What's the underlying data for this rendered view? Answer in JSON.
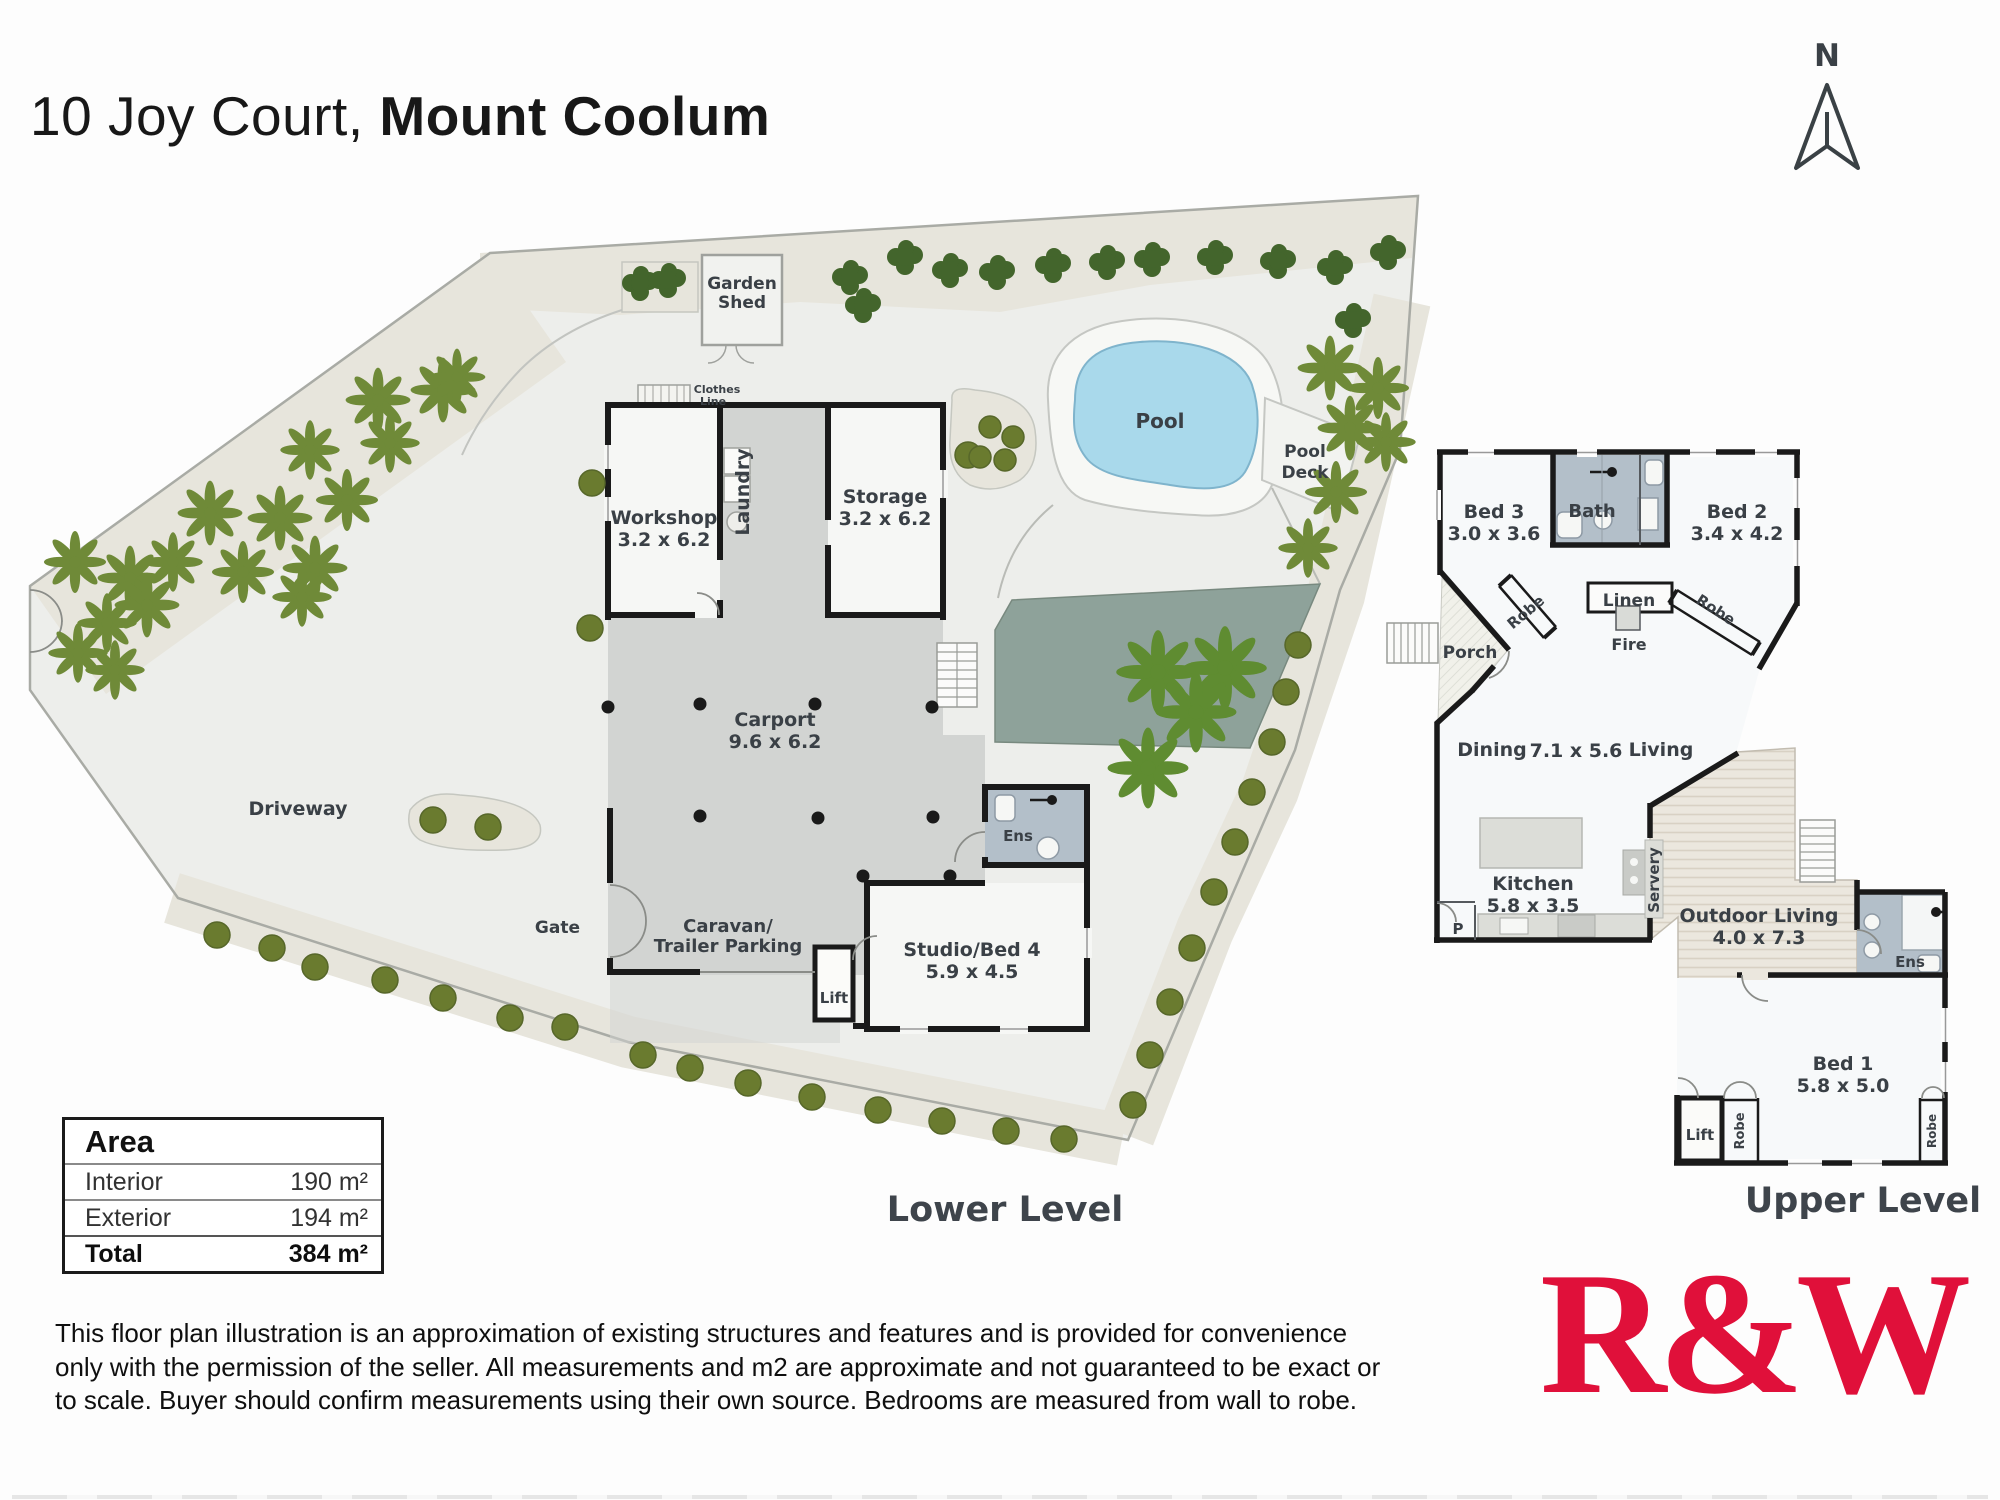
{
  "title": {
    "prefix": "10 Joy Court, ",
    "bold": "Mount Coolum"
  },
  "compass": "N",
  "levels": {
    "lower": "Lower Level",
    "upper": "Upper Level"
  },
  "area_table": {
    "header": "Area",
    "rows": [
      {
        "label": "Interior",
        "value": "190 m²"
      },
      {
        "label": "Exterior",
        "value": "194 m²"
      }
    ],
    "total": {
      "label": "Total",
      "value": "384 m²"
    }
  },
  "lower": {
    "garden_shed_line1": "Garden",
    "garden_shed_line2": "Shed",
    "clothes_line1": "Clothes",
    "clothes_line2": "Line",
    "workshop": "Workshop",
    "workshop_dim": "3.2 x 6.2",
    "laundry": "Laundry",
    "storage": "Storage",
    "storage_dim": "3.2 x 6.2",
    "pool": "Pool",
    "pool_deck_line1": "Pool",
    "pool_deck_line2": "Deck",
    "carport": "Carport",
    "carport_dim": "9.6 x 6.2",
    "driveway": "Driveway",
    "gate": "Gate",
    "caravan_line1": "Caravan/",
    "caravan_line2": "Trailer Parking",
    "lift": "Lift",
    "ens": "Ens",
    "studio": "Studio/Bed 4",
    "studio_dim": "5.9 x 4.5"
  },
  "upper": {
    "bed3": "Bed 3",
    "bed3_dim": "3.0 x 3.6",
    "bath": "Bath",
    "bed2": "Bed 2",
    "bed2_dim": "3.4 x 4.2",
    "linen": "Linen",
    "fire": "Fire",
    "robe_left": "Robe",
    "robe_right": "Robe",
    "porch": "Porch",
    "dining": "Dining",
    "living_dim": "7.1 x 5.6",
    "living": "Living",
    "kitchen": "Kitchen",
    "kitchen_dim": "5.8 x 3.5",
    "servery": "Servery",
    "pantry": "P",
    "outdoor": "Outdoor Living",
    "outdoor_dim": "4.0 x 7.3",
    "ens": "Ens",
    "bed1": "Bed 1",
    "bed1_dim": "5.8 x 5.0",
    "lift": "Lift",
    "robe1": "Robe",
    "robe2": "Robe"
  },
  "disclaimer": {
    "line1": "This floor plan illustration is an approximation of existing structures and features and is provided for convenience",
    "line2": "only with the permission of the seller. All measurements and m2 are approximate and not guaranteed to be exact or",
    "line3": "to scale. Buyer should confirm measurements using their own source. Bedrooms are measured from wall to robe."
  },
  "logo": "R&W",
  "colors": {
    "logo_red": "#E0103A",
    "pool_blue": "#A9D9EB",
    "deck_sage": "#8EA29A",
    "carport_grey": "#D2D4D2",
    "bath_grey": "#B3BFC9",
    "site_grey": "#EDEEEB",
    "garden_beige": "#E7E5DC",
    "wall_black": "#1A1A1A",
    "label_grey": "#3A4046"
  }
}
